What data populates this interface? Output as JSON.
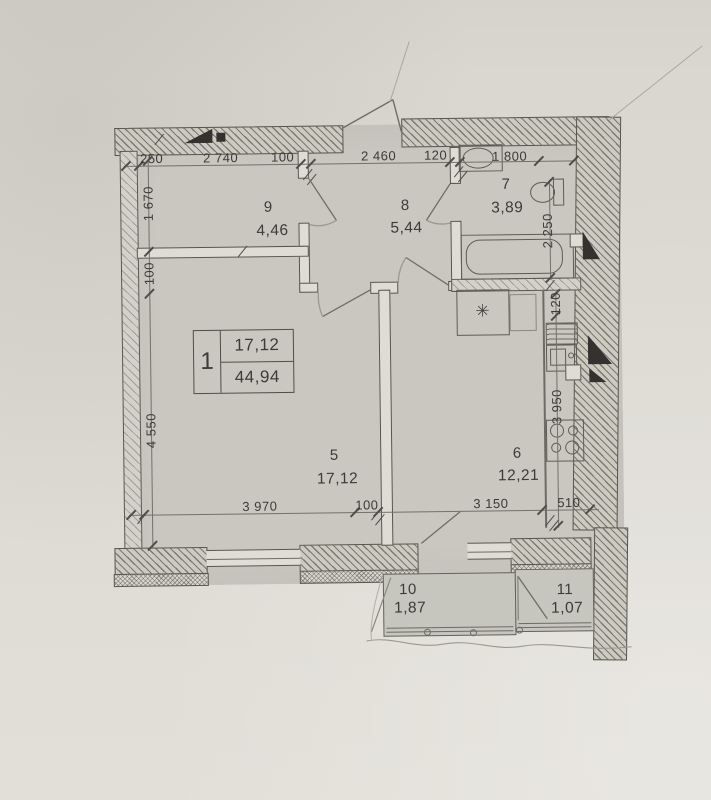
{
  "plan": {
    "stamp": {
      "number": "1",
      "living_area": "17,12",
      "total_area": "44,94"
    },
    "rooms": [
      {
        "number": "5",
        "area": "17,12"
      },
      {
        "number": "6",
        "area": "12,21"
      },
      {
        "number": "7",
        "area": "3,89"
      },
      {
        "number": "8",
        "area": "5,44"
      },
      {
        "number": "9",
        "area": "4,46"
      },
      {
        "number": "10",
        "area": "1,87"
      },
      {
        "number": "11",
        "area": "1,07"
      }
    ],
    "dims": {
      "top": [
        "250",
        "2 740",
        "100",
        "2 460",
        "120",
        "1 800"
      ],
      "left": [
        "1 670",
        "100",
        "4 550"
      ],
      "right": [
        "2 250",
        "120",
        "3 950"
      ],
      "bottom": [
        "3 970",
        "100",
        "3 150",
        "510"
      ]
    },
    "symbols": {
      "vent_star": "✳"
    }
  }
}
